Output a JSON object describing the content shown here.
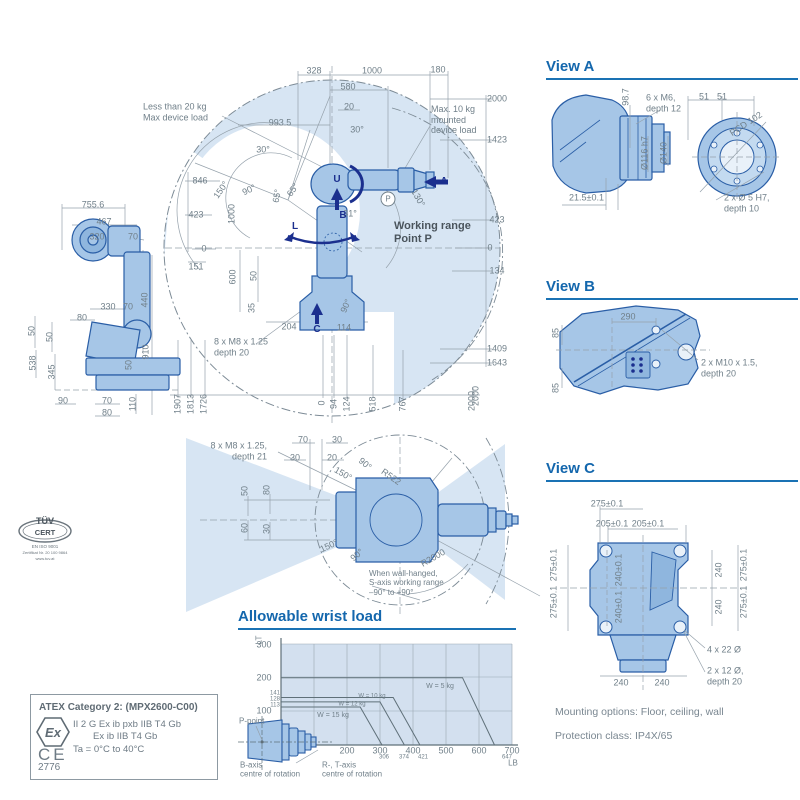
{
  "colors": {
    "accent": "#1467ad",
    "navy": "#1b2f8e",
    "dim": "#71808a",
    "dark": "#4a545c",
    "fill": "#d7e5f3",
    "robot": "#a6c6e7",
    "robot_stroke": "#2a5ea6",
    "line": "#95a1ab"
  },
  "working_range": {
    "labels": [
      {
        "t": "328",
        "x": 314,
        "y": 71
      },
      {
        "t": "1000",
        "x": 372,
        "y": 71
      },
      {
        "t": "180",
        "x": 438,
        "y": 70
      },
      {
        "t": "580",
        "x": 348,
        "y": 87
      },
      {
        "t": "20",
        "x": 349,
        "y": 107
      },
      {
        "t": "993.5",
        "x": 280,
        "y": 123
      },
      {
        "t": "30°",
        "x": 357,
        "y": 130
      },
      {
        "t": "30°",
        "x": 263,
        "y": 150
      },
      {
        "t": "846",
        "x": 200,
        "y": 181
      },
      {
        "t": "150°",
        "x": 221,
        "y": 190,
        "r": -55
      },
      {
        "t": "90°",
        "x": 249,
        "y": 190,
        "r": -25
      },
      {
        "t": "65°",
        "x": 277,
        "y": 196,
        "r": -80
      },
      {
        "t": "65°",
        "x": 293,
        "y": 190,
        "r": -55
      },
      {
        "t": "423",
        "x": 196,
        "y": 215
      },
      {
        "t": "1000",
        "x": 232,
        "y": 214,
        "r": -90
      },
      {
        "t": "0",
        "x": 204,
        "y": 249
      },
      {
        "t": "151",
        "x": 196,
        "y": 267
      },
      {
        "t": "600",
        "x": 233,
        "y": 277,
        "r": -90
      },
      {
        "t": "50",
        "x": 254,
        "y": 276,
        "r": -90
      },
      {
        "t": "35",
        "x": 252,
        "y": 308,
        "r": -90
      },
      {
        "t": "204",
        "x": 289,
        "y": 327
      },
      {
        "t": "114",
        "x": 344,
        "y": 328
      },
      {
        "t": "90°",
        "x": 346,
        "y": 306,
        "r": -65
      },
      {
        "t": "31°",
        "x": 350,
        "y": 214
      },
      {
        "t": "130°",
        "x": 418,
        "y": 198,
        "r": 60
      },
      {
        "t": "2000",
        "x": 497,
        "y": 99
      },
      {
        "t": "1423",
        "x": 497,
        "y": 140
      },
      {
        "t": "423",
        "x": 497,
        "y": 220
      },
      {
        "t": "0",
        "x": 490,
        "y": 248
      },
      {
        "t": "134",
        "x": 497,
        "y": 271
      },
      {
        "t": "1409",
        "x": 497,
        "y": 349
      },
      {
        "t": "1643",
        "x": 497,
        "y": 363
      },
      {
        "t": "2000",
        "x": 476,
        "y": 396,
        "r": -90
      },
      {
        "t": "1907",
        "x": 178,
        "y": 404,
        "r": -90
      },
      {
        "t": "1813",
        "x": 191,
        "y": 404,
        "r": -90
      },
      {
        "t": "1726",
        "x": 204,
        "y": 404,
        "r": -90
      },
      {
        "t": "0",
        "x": 322,
        "y": 403,
        "r": -90
      },
      {
        "t": "94",
        "x": 334,
        "y": 404,
        "r": -90
      },
      {
        "t": "124",
        "x": 347,
        "y": 404,
        "r": -90
      },
      {
        "t": "518",
        "x": 373,
        "y": 404,
        "r": -90
      },
      {
        "t": "767",
        "x": 403,
        "y": 404,
        "r": -90
      },
      {
        "t": "2000",
        "x": 472,
        "y": 401,
        "r": -90
      },
      {
        "t": "Less than 20 kg\nMax device load",
        "x": 143,
        "y": 112,
        "a": "l"
      },
      {
        "t": "Max. 10 kg\nmounted\ndevice load",
        "x": 431,
        "y": 120,
        "a": "l"
      },
      {
        "t": "Working range\nPoint P",
        "x": 394,
        "y": 233,
        "a": "l",
        "b": 1,
        "c": "dark",
        "s": 11
      },
      {
        "t": "8 x M8 x 1.25\ndepth 20",
        "x": 214,
        "y": 347,
        "a": "l"
      },
      {
        "t": "U",
        "x": 337,
        "y": 180,
        "c": "navy",
        "b": 1,
        "s": 10
      },
      {
        "t": "B",
        "x": 343,
        "y": 216,
        "c": "navy",
        "b": 1,
        "s": 10
      },
      {
        "t": "A",
        "x": 444,
        "y": 182,
        "c": "navy",
        "b": 1,
        "s": 10
      },
      {
        "t": "L",
        "x": 295,
        "y": 227,
        "c": "navy",
        "b": 1,
        "s": 10
      },
      {
        "t": "C",
        "x": 317,
        "y": 330,
        "c": "navy",
        "b": 1,
        "s": 10
      },
      {
        "t": "P",
        "x": 388,
        "y": 199,
        "cls": "circ",
        "s": 8
      }
    ]
  },
  "side_view": {
    "labels": [
      {
        "t": "755.6",
        "x": 93,
        "y": 205
      },
      {
        "t": "467",
        "x": 104,
        "y": 222
      },
      {
        "t": "320",
        "x": 97,
        "y": 237
      },
      {
        "t": "70",
        "x": 133,
        "y": 237
      },
      {
        "t": "330",
        "x": 108,
        "y": 307
      },
      {
        "t": "70",
        "x": 128,
        "y": 307
      },
      {
        "t": "80",
        "x": 82,
        "y": 318
      },
      {
        "t": "440",
        "x": 145,
        "y": 300,
        "r": -90
      },
      {
        "t": "910",
        "x": 146,
        "y": 352,
        "r": -90
      },
      {
        "t": "50",
        "x": 32,
        "y": 331,
        "r": -90
      },
      {
        "t": "50",
        "x": 50,
        "y": 337,
        "r": -90
      },
      {
        "t": "538",
        "x": 33,
        "y": 363,
        "r": -90
      },
      {
        "t": "345",
        "x": 52,
        "y": 372,
        "r": -90
      },
      {
        "t": "50",
        "x": 129,
        "y": 365,
        "r": -90
      },
      {
        "t": "90",
        "x": 63,
        "y": 401
      },
      {
        "t": "70",
        "x": 107,
        "y": 401
      },
      {
        "t": "110",
        "x": 133,
        "y": 404,
        "r": -90
      },
      {
        "t": "80",
        "x": 107,
        "y": 413
      }
    ]
  },
  "top_view": {
    "labels": [
      {
        "t": "8 x M8 x 1.25,\ndepth 21",
        "x": 267,
        "y": 451,
        "a": "r"
      },
      {
        "t": "70",
        "x": 303,
        "y": 440
      },
      {
        "t": "30",
        "x": 337,
        "y": 440
      },
      {
        "t": "30",
        "x": 295,
        "y": 458
      },
      {
        "t": "20",
        "x": 332,
        "y": 458
      },
      {
        "t": "90°",
        "x": 365,
        "y": 464,
        "r": 40
      },
      {
        "t": "150°",
        "x": 343,
        "y": 474,
        "r": 30
      },
      {
        "t": "R522",
        "x": 391,
        "y": 477,
        "r": 35
      },
      {
        "t": "50",
        "x": 245,
        "y": 491,
        "r": -90
      },
      {
        "t": "80",
        "x": 267,
        "y": 490,
        "r": -90
      },
      {
        "t": "60",
        "x": 245,
        "y": 528,
        "r": -90
      },
      {
        "t": "30",
        "x": 267,
        "y": 529,
        "r": -90
      },
      {
        "t": "150°",
        "x": 329,
        "y": 546,
        "r": -25
      },
      {
        "t": "90°",
        "x": 357,
        "y": 555,
        "r": -40
      },
      {
        "t": "R2000",
        "x": 433,
        "y": 558,
        "r": -30
      },
      {
        "t": "When wall-hanged,\nS-axis working range\n–90° to +90°",
        "x": 369,
        "y": 583,
        "a": "l",
        "s": 8
      }
    ]
  },
  "view_a": {
    "title": "View A",
    "labels": [
      {
        "t": "98.7",
        "x": 626,
        "y": 97,
        "r": -90
      },
      {
        "t": "6 x M6,\ndepth 12",
        "x": 646,
        "y": 103,
        "a": "l"
      },
      {
        "t": "51",
        "x": 704,
        "y": 97
      },
      {
        "t": "51",
        "x": 722,
        "y": 97
      },
      {
        "t": "PCD 102",
        "x": 746,
        "y": 124,
        "r": -33
      },
      {
        "t": "Ø116 h7",
        "x": 645,
        "y": 153,
        "r": -90
      },
      {
        "t": "Ø140",
        "x": 664,
        "y": 153,
        "r": -90
      },
      {
        "t": "21.5±0.1",
        "x": 569,
        "y": 198,
        "a": "l"
      },
      {
        "t": "2 x Ø 5 H7,\ndepth 10",
        "x": 724,
        "y": 203,
        "a": "l"
      }
    ]
  },
  "view_b": {
    "title": "View B",
    "labels": [
      {
        "t": "290",
        "x": 628,
        "y": 317
      },
      {
        "t": "85",
        "x": 556,
        "y": 333,
        "r": -90
      },
      {
        "t": "85",
        "x": 556,
        "y": 388,
        "r": -90
      },
      {
        "t": "2 x M10 x 1.5,\ndepth 20",
        "x": 701,
        "y": 368,
        "a": "l"
      }
    ]
  },
  "view_c": {
    "title": "View C",
    "labels": [
      {
        "t": "275±0.1",
        "x": 607,
        "y": 504
      },
      {
        "t": "205±0.1",
        "x": 612,
        "y": 524
      },
      {
        "t": "205±0.1",
        "x": 648,
        "y": 524
      },
      {
        "t": "275±0.1",
        "x": 554,
        "y": 565,
        "r": -90
      },
      {
        "t": "275±0.1",
        "x": 554,
        "y": 602,
        "r": -90
      },
      {
        "t": "240±0.1",
        "x": 619,
        "y": 570,
        "r": -90
      },
      {
        "t": "240±0.1",
        "x": 619,
        "y": 607,
        "r": -90
      },
      {
        "t": "240",
        "x": 719,
        "y": 570,
        "r": -90
      },
      {
        "t": "240",
        "x": 719,
        "y": 607,
        "r": -90
      },
      {
        "t": "275±0.1",
        "x": 744,
        "y": 565,
        "r": -90
      },
      {
        "t": "275±0.1",
        "x": 744,
        "y": 602,
        "r": -90
      },
      {
        "t": "240",
        "x": 621,
        "y": 683
      },
      {
        "t": "240",
        "x": 662,
        "y": 683
      },
      {
        "t": "4 x 22 Ø",
        "x": 707,
        "y": 650,
        "a": "l"
      },
      {
        "t": "2 x 12 Ø,\ndepth 20",
        "x": 707,
        "y": 676,
        "a": "l"
      }
    ]
  },
  "wrist_load": {
    "title": "Allowable wrist load",
    "labels": [
      {
        "t": "LT",
        "x": 259,
        "y": 640,
        "r": -90,
        "s": 8
      },
      {
        "t": "300",
        "x": 264,
        "y": 645
      },
      {
        "t": "200",
        "x": 264,
        "y": 678
      },
      {
        "t": "141",
        "x": 275,
        "y": 694,
        "s": 6
      },
      {
        "t": "128",
        "x": 275,
        "y": 700,
        "s": 6
      },
      {
        "t": "113",
        "x": 275,
        "y": 706,
        "s": 6
      },
      {
        "t": "100",
        "x": 264,
        "y": 711
      },
      {
        "t": "200",
        "x": 347,
        "y": 751
      },
      {
        "t": "300",
        "x": 380,
        "y": 751
      },
      {
        "t": "306",
        "x": 384,
        "y": 758,
        "s": 6
      },
      {
        "t": "400",
        "x": 413,
        "y": 751
      },
      {
        "t": "374",
        "x": 404,
        "y": 758,
        "s": 6
      },
      {
        "t": "421",
        "x": 423,
        "y": 758,
        "s": 6
      },
      {
        "t": "500",
        "x": 446,
        "y": 751
      },
      {
        "t": "600",
        "x": 479,
        "y": 751
      },
      {
        "t": "647",
        "x": 507,
        "y": 758,
        "s": 6
      },
      {
        "t": "700",
        "x": 512,
        "y": 751
      },
      {
        "t": "LB",
        "x": 513,
        "y": 763,
        "s": 8
      },
      {
        "t": "W = 5 kg",
        "x": 440,
        "y": 687,
        "s": 7
      },
      {
        "t": "W = 10 kg",
        "x": 372,
        "y": 697,
        "s": 6
      },
      {
        "t": "W = 12 kg",
        "x": 352,
        "y": 705,
        "s": 6
      },
      {
        "t": "W = 15 kg",
        "x": 333,
        "y": 716,
        "s": 7
      },
      {
        "t": "P-point",
        "x": 239,
        "y": 721,
        "a": "l",
        "s": 8
      },
      {
        "t": "B-axis\ncentre of rotation",
        "x": 240,
        "y": 770,
        "a": "l",
        "s": 8
      },
      {
        "t": "R-, T-axis\ncentre of rotation",
        "x": 322,
        "y": 770,
        "a": "l",
        "s": 8
      }
    ],
    "chart_data": {
      "type": "line",
      "xlabel": "LB",
      "ylabel": "LT",
      "xlim": [
        0,
        700
      ],
      "ylim": [
        0,
        300
      ],
      "x_ticks": [
        200,
        300,
        400,
        500,
        600,
        700
      ],
      "x_minor_ticks": [
        306,
        374,
        421,
        647
      ],
      "y_ticks": [
        100,
        200,
        300
      ],
      "y_minor_ticks": [
        113,
        128,
        141
      ],
      "grid": true,
      "series": [
        {
          "name": "W = 15 kg",
          "points": [
            [
              0,
              113
            ],
            [
              240,
              113
            ],
            [
              306,
              0
            ]
          ]
        },
        {
          "name": "W = 12 kg",
          "points": [
            [
              0,
              128
            ],
            [
              300,
              128
            ],
            [
              374,
              0
            ]
          ]
        },
        {
          "name": "W = 10 kg",
          "points": [
            [
              0,
              141
            ],
            [
              340,
              141
            ],
            [
              421,
              0
            ]
          ]
        },
        {
          "name": "W = 5 kg",
          "points": [
            [
              0,
              200
            ],
            [
              550,
              200
            ],
            [
              647,
              0
            ]
          ]
        }
      ]
    }
  },
  "atex": {
    "title": "ATEX Category 2: (MPX2600-C00)",
    "line1": "II 2 G Ex ib pxb IIB T4 Gb",
    "line2": "Ex ib IIB T4 Gb",
    "line3": "Ta = 0°C to 40°C",
    "number": "2776",
    "ex_mark": "Ex",
    "ce_mark": "CE"
  },
  "tuv": {
    "line1": "TÜV",
    "line2": "CERT",
    "line3": "EN ISO 9001",
    "line4": "Zertifikat Nr. 20 100 9864",
    "line5": "www.tuv.at"
  },
  "footer": {
    "mounting": "Mounting options: Floor, ceiling, wall",
    "protection": "Protection class: IP4X/65"
  }
}
